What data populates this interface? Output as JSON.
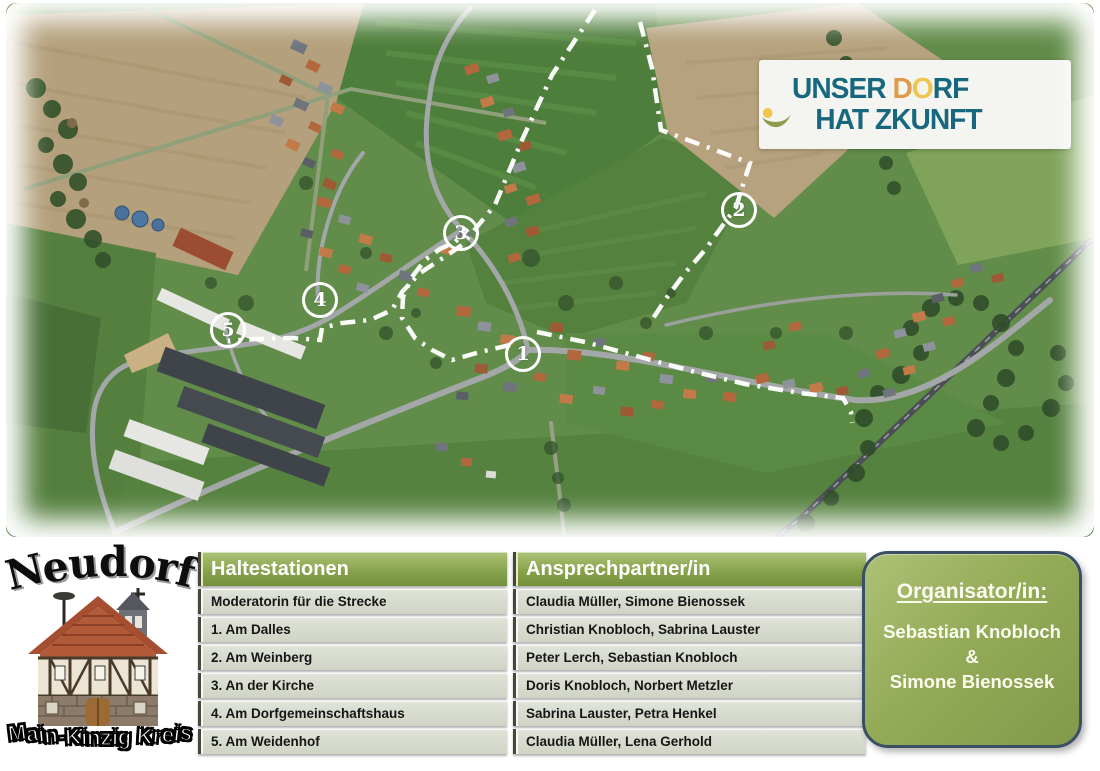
{
  "map": {
    "description": "Luftbild des Dorfes Neudorf mit eingezeichneter Route",
    "markers": [
      {
        "label": "1",
        "x": 514,
        "y": 348
      },
      {
        "label": "2",
        "x": 730,
        "y": 204
      },
      {
        "label": "3",
        "x": 452,
        "y": 227
      },
      {
        "label": "4",
        "y": 294,
        "x": 311
      },
      {
        "label": "5",
        "x": 219,
        "y": 324
      }
    ],
    "logo": {
      "line1_part1": "UNSER ",
      "line1_d": "D",
      "line1_o": "O",
      "line1_part2": "RF",
      "line2_part1": "HAT Z",
      "line2_part2": "KUNFT"
    }
  },
  "branding": {
    "village_name": "Neudorf",
    "district_name": "Main-Kinzig Kreis"
  },
  "table": {
    "columns": [
      "Haltestationen",
      "Ansprechpartner/in"
    ],
    "rows": [
      {
        "station": "Moderatorin für die Strecke",
        "contact": "Claudia Müller, Simone Bienossek"
      },
      {
        "station": "1. Am Dalles",
        "contact": "Christian Knobloch, Sabrina Lauster"
      },
      {
        "station": "2. Am Weinberg",
        "contact": "Peter Lerch, Sebastian Knobloch"
      },
      {
        "station": "3. An der Kirche",
        "contact": "Doris Knobloch, Norbert Metzler"
      },
      {
        "station": "4. Am Dorfgemeinschaftshaus",
        "contact": "Sabrina Lauster, Petra Henkel"
      },
      {
        "station": "5. Am Weidenhof",
        "contact": "Claudia Müller, Lena Gerhold"
      }
    ]
  },
  "organizer": {
    "title": "Organisator/in:",
    "name1": "Sebastian Knobloch",
    "separator": "&",
    "name2": "Simone Bienossek"
  },
  "colors": {
    "logo_teal": "#17687f",
    "logo_orange": "#df9b4c",
    "logo_yellow": "#edc74d",
    "logo_smile_green": "#8f9b4a",
    "table_header_green": "#7d9844",
    "table_row_bg": "#d7dbce",
    "organizer_green": "#8ea653",
    "organizer_border": "#3a4f63",
    "route_color": "#ffffff"
  }
}
